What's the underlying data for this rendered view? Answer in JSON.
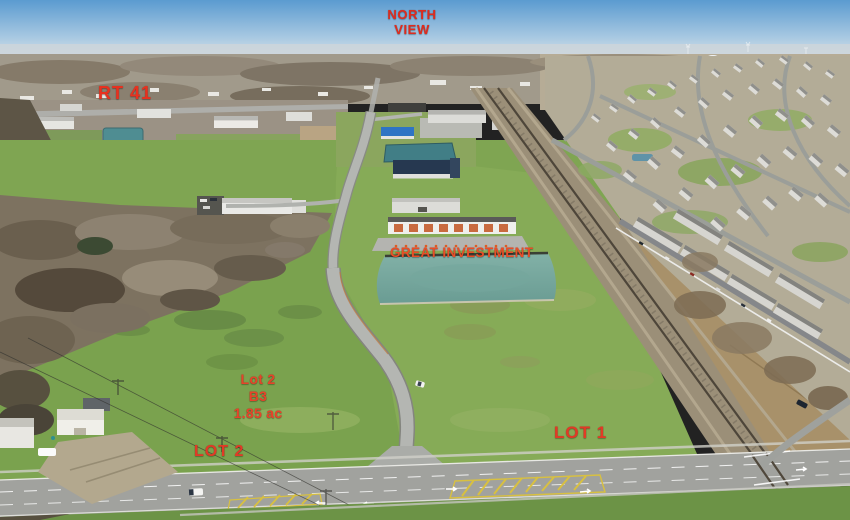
{
  "scene": {
    "type": "aerial-drone-photograph",
    "description": "Winter aerial view of commercial land lots for sale along Rt 41, with an access road, retention pond, commercial buildings, railroad tracks and a residential subdivision"
  },
  "annotations": {
    "north_view": {
      "line1": "NORTH",
      "line2": "VIEW",
      "color": "#de2c1e"
    },
    "route": {
      "label": "RT 41",
      "color": "#e8311f"
    },
    "investment": {
      "label": "GREAT INVESTMENT",
      "color": "#e84e28"
    },
    "lot2_details": {
      "line1": "Lot 2",
      "line2": "B3",
      "line3": "1.85 ac",
      "color": "#e6442a"
    },
    "lot2": {
      "label": "LOT 2",
      "color": "#e23a26"
    },
    "lot1": {
      "label": "LOT 1",
      "color": "#e23a26"
    }
  }
}
